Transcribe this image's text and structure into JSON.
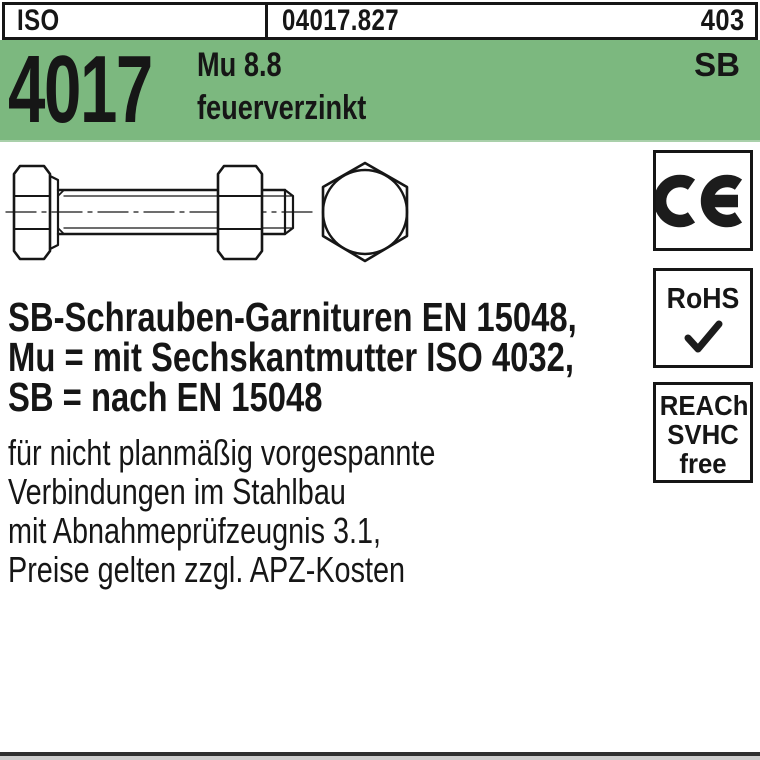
{
  "colors": {
    "header_green": "#7cb87f",
    "ink": "#161616"
  },
  "header": {
    "standard_org": "ISO",
    "article_number": "04017.827",
    "page_number": "403",
    "standard_number": "4017",
    "material_grade": "Mu 8.8",
    "finish": "feuerverzinkt",
    "sb_mark": "SB"
  },
  "certifications": {
    "ce_label": "CE",
    "rohs_label": "RoHS",
    "rohs_check": "✔",
    "reach_lines": [
      "REACh",
      "SVHC",
      "free"
    ]
  },
  "description": {
    "bold_lines": [
      "SB-Schrauben-Garnituren EN 15048,",
      "Mu = mit Sechskantmutter ISO 4032,",
      "SB = nach EN 15048"
    ],
    "regular_lines": [
      "für nicht planmäßig vorgespannte",
      "Verbindungen im Stahlbau",
      "mit Abnahmeprüfzeugnis 3.1,",
      "Preise gelten zzgl. APZ-Kosten"
    ]
  },
  "drawing": {
    "caption": "hex-bolt-with-hex-nut-side-and-end-view"
  }
}
